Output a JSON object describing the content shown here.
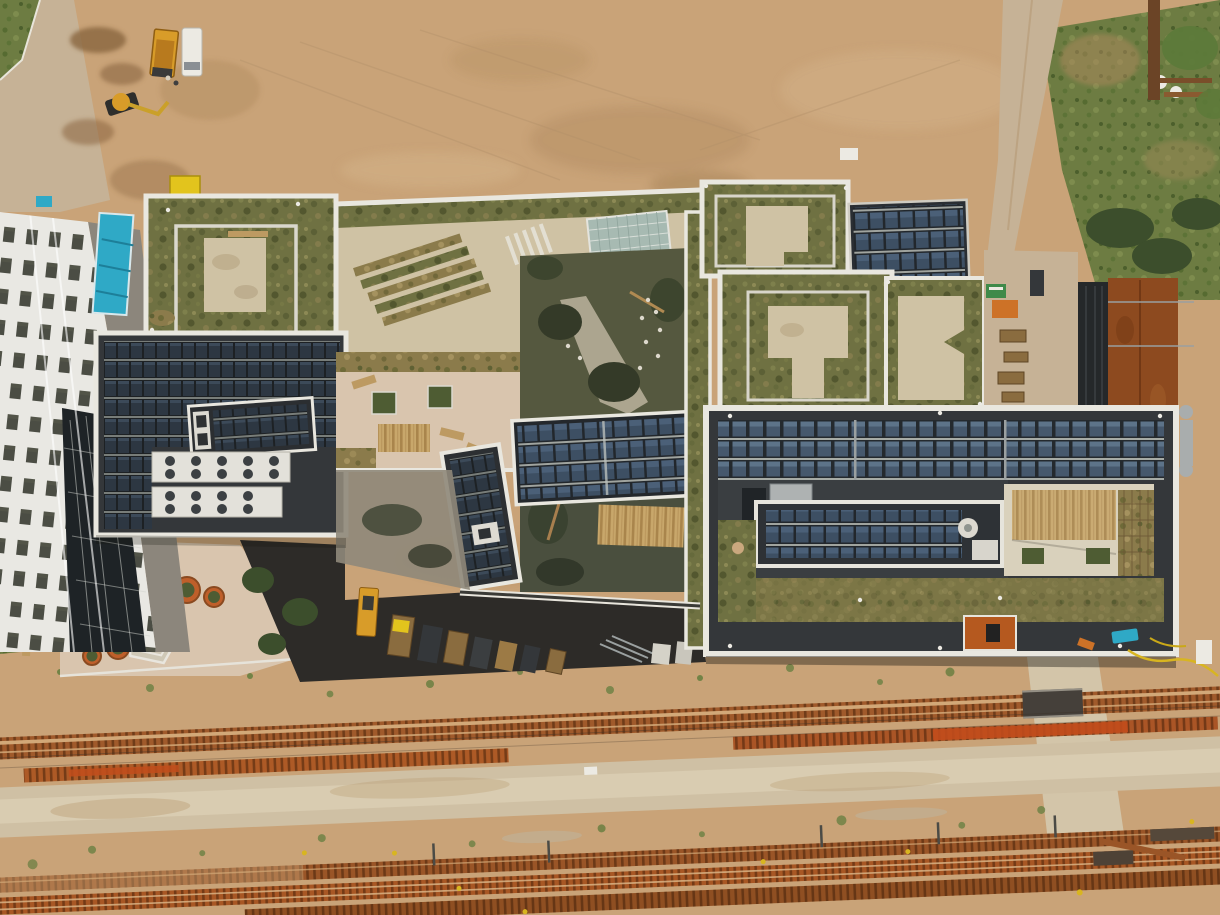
{
  "scene": {
    "description": "Top-down aerial drone photograph of a modern mixed-use building complex with extensive green roofs, white roof parapets and rooftop photovoltaic arrays. A sandy construction field spans the top, with an excavator, dump truck, white van and site containers at top left. A white residential tower stands at the left edge. A plaza with round terracotta planters and a pentagonal seating sculpture sits bottom-left. A corten-steel-roofed building and grass field occupy the right edge. Several rusty railway tracks with a level crossing run horizontally across the bottom of the frame.",
    "type_label": "aerial-photo"
  },
  "palette": {
    "sand": "#c9a378",
    "sandLight": "#d6b78e",
    "sandDark": "#b08a5c",
    "mud": "#8a6540",
    "road": "#c6b296",
    "paved": "#d9c5ae",
    "pavedLight": "#d3c5a9",
    "concrete": "#cfc2a4",
    "parapet": "#e9e7df",
    "parapetDim": "#cfccc0",
    "membrane": "#34373a",
    "membraneLight": "#45494c",
    "asphalt": "#2d2b28",
    "white": "#eceae3",
    "teal": "#2fa9c6",
    "safetyYellow": "#e2c41d",
    "truckYellow": "#d89c29",
    "machineOrange": "#cd7227",
    "glass": "#a7bab2",
    "windowDark": "#3e4036",
    "darkFacade": "#25282a",
    "rustRoof": "#8d4a1f",
    "railRust": "#a05a2b",
    "railBright": "#c24d1c",
    "wood": "#bd9a62",
    "terracotta": "#bf5f2a",
    "greenRoof": "#6f7142",
    "greenDark": "#474f33",
    "greenBright": "#5d7a3a",
    "grassField": "#6d7c42",
    "vegBrown": "#8b7b4b",
    "shrub": "#4e5c33",
    "pipeGray": "#a9adad",
    "treeDark": "#3c4e2c",
    "shadow": "rgba(22,19,14,0.4)",
    "sleeper": "#3e1e08",
    "railLine": "#d2a878"
  },
  "features": [
    "sandy construction field",
    "excavator",
    "dump truck",
    "white van",
    "yellow site container",
    "teal site container",
    "white residential tower",
    "green roofs with white parapets",
    "rooftop solar panel arrays",
    "rooftop HVAC units with fans",
    "roof terrace with shrub planters and wooden loungers",
    "glass skylight",
    "courtyard garden with trees and paths",
    "pergola deck with timber slats",
    "plaza with terracotta planters and pentagonal seating",
    "stacked construction materials on asphalt",
    "corten-roofed building with rooftop pipes",
    "grass field",
    "dirt access road",
    "railway tracks with rusty sleepers",
    "level crossing",
    "overhead line masts",
    "yellow site hose",
    "teal tarp"
  ]
}
